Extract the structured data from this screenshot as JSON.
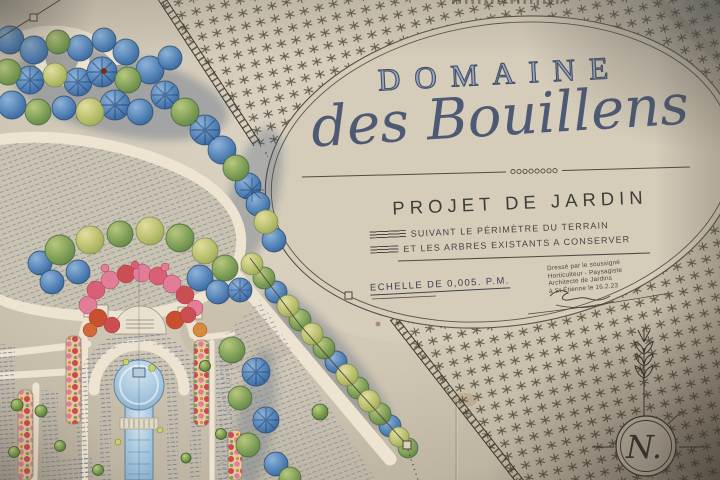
{
  "photo": {
    "subject": "Photograph of a hand-drawn watercolour garden design plan on aged paper"
  },
  "plan": {
    "estate_name_line1": "DOMAINE",
    "estate_name_line2": "des Bouillens",
    "project_title": "PROJET DE JARDIN",
    "project_subtitle_line1": "SUIVANT LE PÉRIMÈTRE DU TERRAIN",
    "project_subtitle_line2": "ET LES ARBRES EXISTANTS A CONSERVER",
    "scale_note": "ECHELLE DE 0,005. P.M.",
    "attribution_line1": "Dressé par le soussigné",
    "attribution_line2": "Horticulteur - Paysagiste",
    "attribution_line3": "Architecte de Jardins",
    "attribution_line4": "à St Étienne le 16.2.23",
    "compass_letter": "N."
  },
  "colors": {
    "parchment": "#cfc6b4",
    "ink": "#3f3b31",
    "title_blue_gray": "#4e5a74",
    "tree_blue": "#2c5387",
    "tree_green": "#54763f",
    "tree_yellow": "#b5bd6a",
    "flower_pink": "#e27d97",
    "flower_red": "#cb4f52",
    "water_blue": "#a5c6dd"
  }
}
